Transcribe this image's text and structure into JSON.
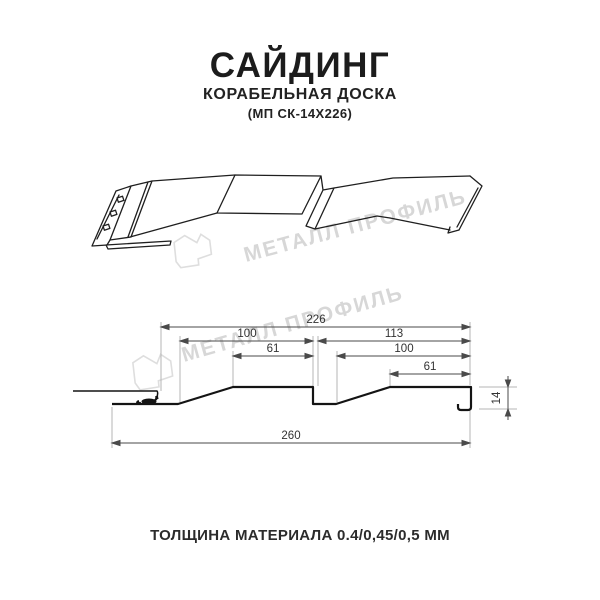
{
  "header": {
    "title": "САЙДИНГ",
    "subtitle": "КОРАБЕЛЬНАЯ ДОСКА",
    "code": "(МП СК-14Х226)"
  },
  "watermark": {
    "brand": "МЕТАЛЛ ПРОФИЛЬ",
    "color": "#d7d7d7"
  },
  "section_dims": {
    "overall_top": "226",
    "left_pitch": "100",
    "left_flat": "61",
    "right_span": "113",
    "right_pitch": "100",
    "right_flat": "61",
    "depth": "14",
    "overall_bottom": "260"
  },
  "footer": {
    "thickness": "ТОЛЩИНА МАТЕРИАЛА 0.4/0,45/0,5 ММ"
  },
  "colors": {
    "line": "#1a1a1a",
    "dimension": "#4a4a4a",
    "extension": "#b5b5b5",
    "watermark": "#d7d7d7",
    "text": "#1f1f1f"
  }
}
